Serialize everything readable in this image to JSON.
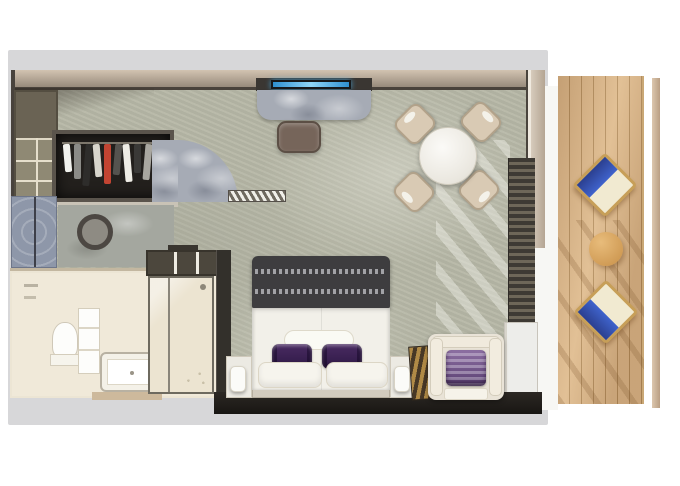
{
  "scene": {
    "kind": "3d-floor-plan-rendering",
    "description": "3D rendered top-down floor plan of a suite with entry, walk-in closet, marble vanity, bathroom with tub and glass shower, bedroom with king bed, TV console with ottoman, round dining table with four chairs, armchair corner, curtained glass wall and a private wooden balcony with two lounge chairs and a side table",
    "rooms": [
      {
        "id": "entry",
        "name": "entry"
      },
      {
        "id": "wardrobe",
        "name": "walk-in-closet"
      },
      {
        "id": "bathroom",
        "name": "bathroom"
      },
      {
        "id": "bedroom",
        "name": "bedroom"
      },
      {
        "id": "dining-nook",
        "name": "dining-nook"
      },
      {
        "id": "balcony",
        "name": "balcony"
      }
    ],
    "furniture": [
      "wardrobe-with-hanging-clothes",
      "wall-shelving",
      "vanity-counter-round-sink",
      "door-swing-arc",
      "entry-door-leaf",
      "toilet",
      "bathroom-vanity",
      "bathtub",
      "glass-shower",
      "tv-screen",
      "media-console",
      "ottoman",
      "round-dining-table",
      "dining-chair x4",
      "king-bed",
      "bed-runner",
      "accent-pillow-purple x2",
      "white-pillow x2",
      "nightstand-with-lamp x2",
      "gold-luggage-rack",
      "armchair-with-purple-cushion",
      "curtains",
      "balcony-lounge-chair x2",
      "balcony-side-table"
    ],
    "wardrobe": {
      "garment_colors": [
        "#f2f2ee",
        "#8b8b87",
        "#2e2d2b",
        "#d8d5cc",
        "#c24432",
        "#55534f",
        "#efede6",
        "#3a3937",
        "#a9a7a0",
        "#6b6965"
      ]
    },
    "dining": {
      "chair_count": 4
    },
    "balcony": {
      "deck_chair_count": 2,
      "towel_color": "#3f63cc"
    }
  },
  "colors": {
    "page_bg": "#ffffff",
    "backdrop": "#d7d7d9",
    "carpet": "#b6b7a6",
    "shelf_olive": "#8f8974",
    "closet_dark": "#23201d",
    "marble": "#a6abb5",
    "tile_blue": "#8e97a9",
    "bath_floor": "#f0e9d9",
    "fixture_white": "#fdfdfb",
    "tub_outline": "#b8b1a2",
    "bed_throw": "#3e3d3f",
    "throw_stripe": "#b4b4b8",
    "duvet": "#f2f0e9",
    "pillow_purple": "#7c5d92",
    "pillow_purple_dark": "#53396b",
    "headboard_bar": "#d2cbbe",
    "nightstand": "#eceae3",
    "armchair": "#e9e3d7",
    "gold_rack": "#b08a46",
    "tv_frame": "#16181a",
    "tv_screen": "#49b2ee",
    "ottoman": "#76655a",
    "chair_beige": "#d9cab4",
    "chair_edge": "#b2a28a",
    "door_hatch": "#6f6a60",
    "deck_wood": "#dcb88c",
    "deck_chair_frame": "#c79f58",
    "deck_cushion": "#f1ead1",
    "towel_blue": "#3f63cc",
    "towel_blue_dark": "#2b3f8f"
  }
}
